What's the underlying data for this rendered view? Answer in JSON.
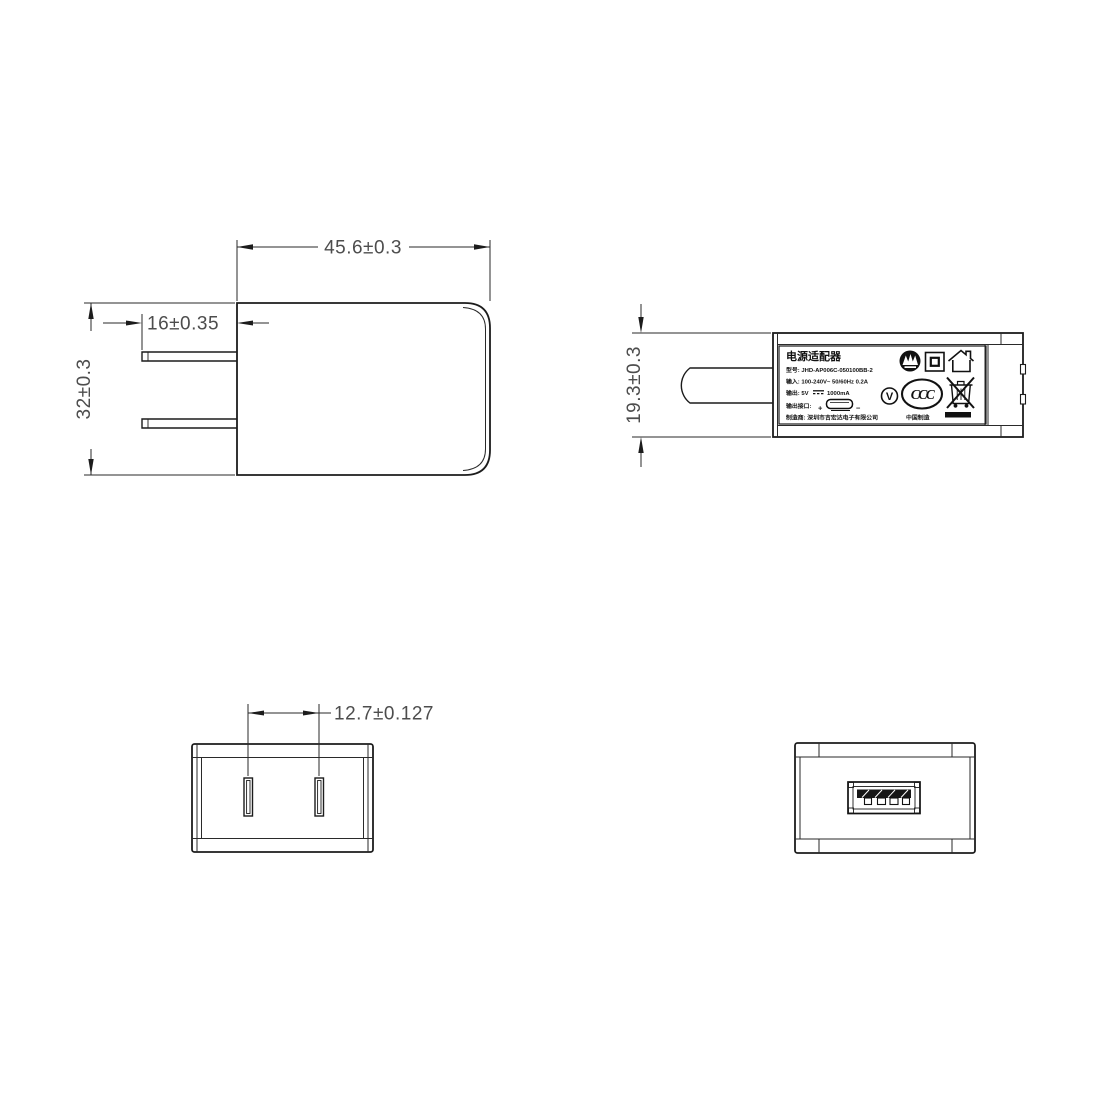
{
  "drawing": {
    "dims": {
      "body_width": "45.6±0.3",
      "prong_length": "16±0.35",
      "body_height": "32±0.3",
      "body_thickness": "19.3±0.3",
      "prong_spacing": "12.7±0.127"
    },
    "label": {
      "title": "电源适配器",
      "model": "型号: JHD-AP006C-050100BB-2",
      "input": "输入: 100-240V~  50/60Hz  0.2A",
      "output_prefix": "输出: 5V",
      "output_suffix": "1000mA",
      "port_label": "输出接口:",
      "port_plus": "+",
      "port_minus": "−",
      "manufacturer": "制造商: 深圳市吉宏达电子有限公司",
      "made_in": "中国制造",
      "ccc": "CCC",
      "efficiency": "V"
    },
    "colors": {
      "line": "#1c1c1c",
      "dim_text": "#4d4d4d",
      "background": "#ffffff"
    }
  }
}
